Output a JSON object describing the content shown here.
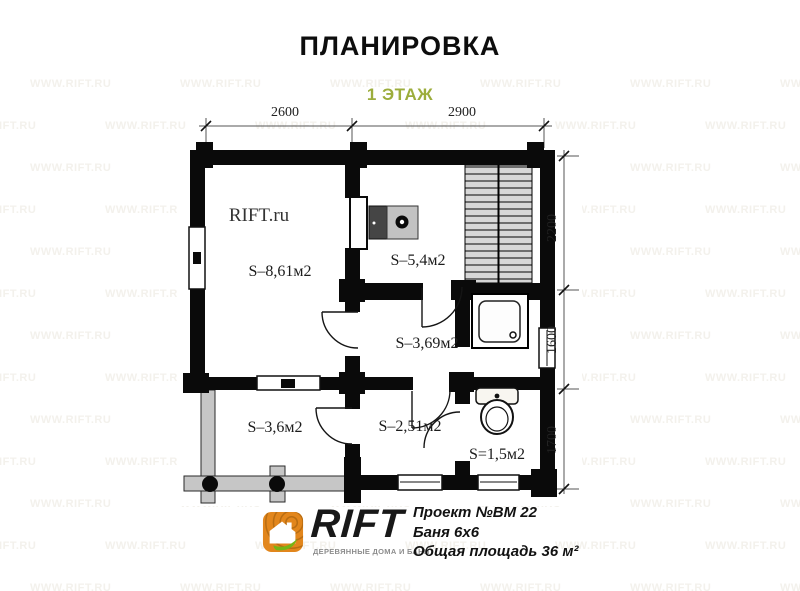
{
  "page": {
    "title": "ПЛАНИРОВКА",
    "subtitle": "1 ЭТАЖ",
    "watermark_tile": "WWW.RIFT.RU",
    "plan_brand_watermark": "RIFT.ru"
  },
  "colors": {
    "accent_green": "#9cad3c",
    "logo_orange": "#e2861c",
    "leaf_green": "#76b414",
    "wall_black": "#0a0a0a",
    "porch_gray": "#c6c6c6",
    "watermark": "#f3f1ec"
  },
  "dimensions": {
    "top": [
      "2600",
      "2900"
    ],
    "right": [
      "2200",
      "1600",
      "1700"
    ]
  },
  "rooms": [
    {
      "label": "S–8,61м2"
    },
    {
      "label": "S–5,4м2"
    },
    {
      "label": "S–3,69м2"
    },
    {
      "label": "S–3,6м2"
    },
    {
      "label": "S–2,51м2"
    },
    {
      "label": "S=1,5м2"
    }
  ],
  "icons": {
    "stove": "dark-firebox-with-burner-circle",
    "sauna_benches": "striped-slat-columns",
    "shower": "square-tray-with-drain",
    "toilet": "tank-and-bowl",
    "porch_posts": "filled-circle-posts",
    "logo": "wood-rings-house-with-leaf"
  },
  "footer": {
    "brand": "RIFT",
    "brand_caption": "ДЕРЕВЯННЫЕ ДОМА И БАНИ",
    "project_no": "Проект №ВМ 22",
    "building": "Баня 6х6",
    "total_area": "Общая площадь 36 м²"
  }
}
